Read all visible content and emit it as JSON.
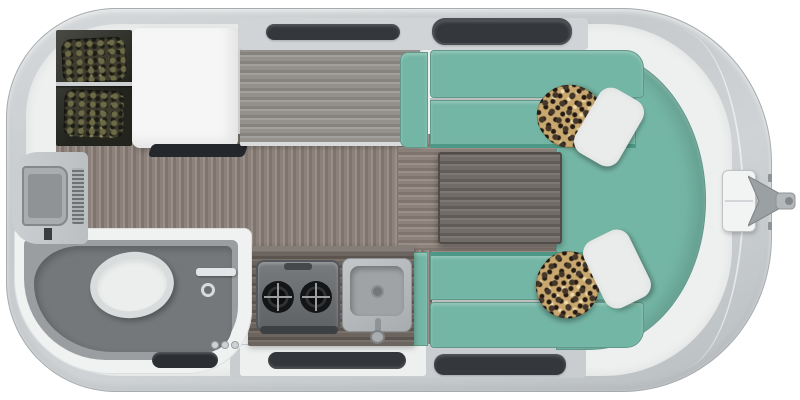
{
  "description": "Top-down rendered floor plan of a single-axle travel trailer with hitch at right: wet bath, TV wall and wardrobe at rear (left), refrigerator cabinet, gray counter, two-burner stove and sink galley, entry door, and a teal U-shaped dinette with wood table, two white pillows and two leopard-print pillows at the front (right).",
  "canvas": {
    "width": 800,
    "height": 400,
    "pageBg": "#ffffff"
  },
  "colors": {
    "pageBg": "#ffffff",
    "shell": "#c6cacc",
    "shellEdge": "#a7acaf",
    "interior": "#eef0f0",
    "floorWood": "#8d837c",
    "floorWoodLight": "#9a9089",
    "floorWoodDark": "#7f756e",
    "counterGray": "#94918d",
    "counterGrayLight": "#a39f9a",
    "counterGrayDark": "#86827e",
    "counterDark": "#6b645f",
    "counterDarkLight": "#79706a",
    "counterDarkShade": "#5c554f",
    "teal": "#74b6a5",
    "tealDark": "#4e9886",
    "tableWood": "#716c68",
    "tableWoodLight": "#7d7874",
    "tableWoodDark": "#615c58",
    "windowDark": "#34373b",
    "pillowWhite": "#e9ecea",
    "leopardBase": "#c8a86e",
    "leopardSpot": "#43362a",
    "clothesOlive": "#6d6b46",
    "cabinetWhite": "#f5f6f5",
    "bathFloor": "#9a9ea0",
    "showerPan": "#75787b",
    "fixtureWhite": "#eceeee",
    "matDark": "#33363a"
  },
  "fixtures": {
    "wardrobe": "closet with hanging patterned clothes on rod",
    "refrigerator_cabinet": "white cabinet block",
    "counter_gray": "gray wood-grain counter top",
    "dinette": "teal U-shaped bench lounge",
    "table": "dark wood pedestal table",
    "pillows": [
      "white lumbar pillow (top)",
      "leopard pillow (top)",
      "white lumbar pillow (bottom)",
      "leopard pillow (bottom)"
    ],
    "kitchen": "dark wood galley counter with two-burner stove and square sink",
    "entry_door": "curbside door with dark step mat",
    "wet_bath": "gray shower pan, toilet, wall mixer, three knobs, floor vent",
    "tv": "rear-wall mounted television with speaker grille",
    "hitch": "propane tank cover, A-frame tongue and coupler",
    "windows": [
      "slim window above counter",
      "window above dinette (top wall)",
      "window below dinette (bottom wall)"
    ]
  }
}
